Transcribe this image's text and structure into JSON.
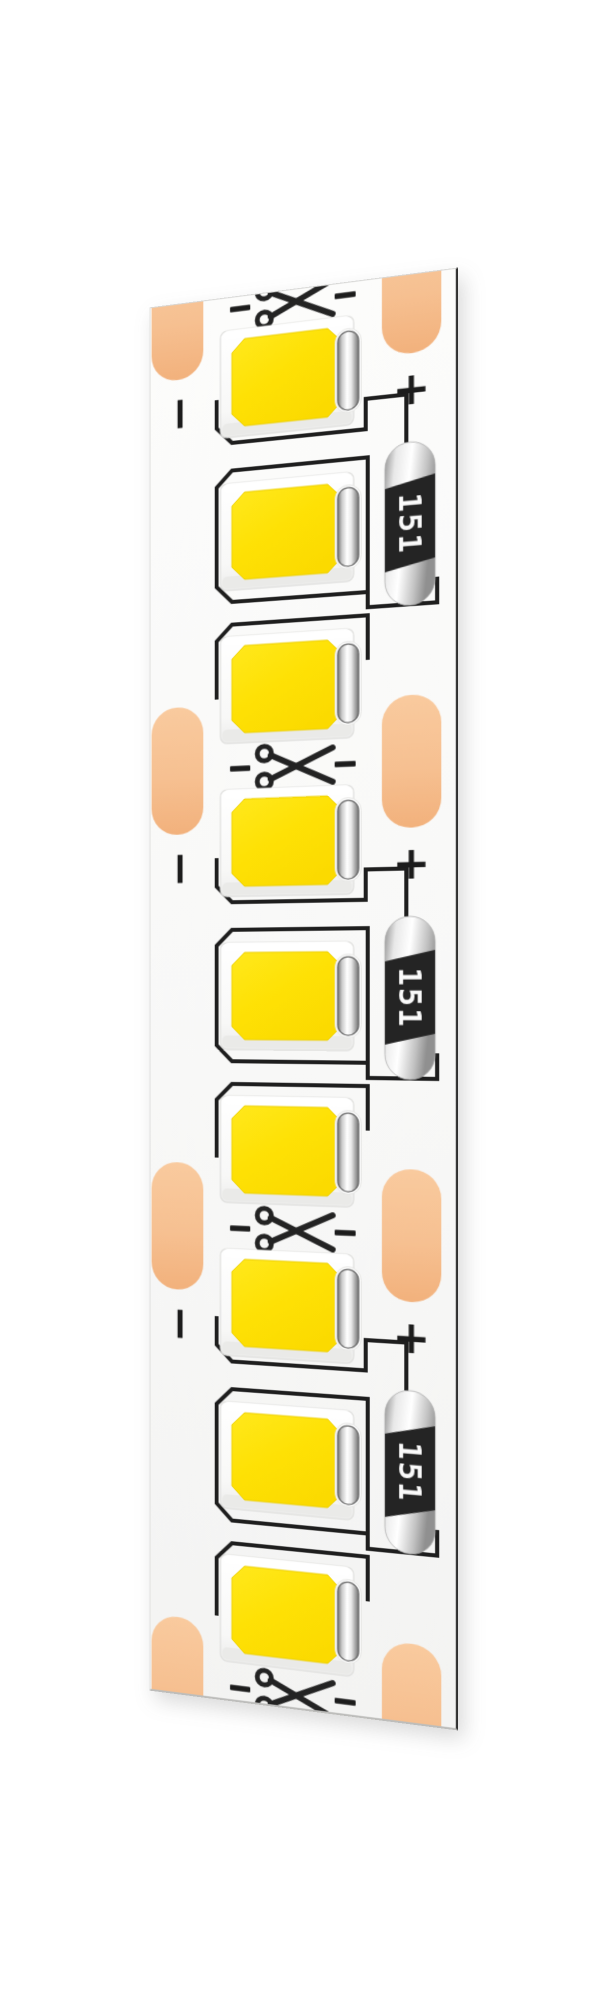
{
  "page": {
    "background_color": "#FFFFFF"
  },
  "strip": {
    "kind_label": "smd-led-strip",
    "surface_color": "#FAFAF9",
    "pad_color_top": "#F9CA9E",
    "pad_color_bottom": "#F2B17C",
    "led_yellow_light": "#FFE81C",
    "led_yellow_deep": "#FBDA00",
    "package_white": "#FFFFFF",
    "trace_color": "#1E1E1E",
    "mark_color": "#1C1C1C",
    "scissors_color": "#232323",
    "resistor_body_color": "#242424",
    "resistor_text_color": "#FAFAFA",
    "led_count": 9,
    "cut_mark_count": 4,
    "resistor_count": 3,
    "cut_marks": [
      {
        "icon": "scissors-icon",
        "clipped": true
      },
      {
        "icon": "scissors-icon",
        "clipped": false
      },
      {
        "icon": "scissors-icon",
        "clipped": false
      },
      {
        "icon": "scissors-icon",
        "clipped": true
      }
    ],
    "segments": [
      {
        "minus_label": "−",
        "plus_label": "+",
        "resistor_label": "151"
      },
      {
        "minus_label": "−",
        "plus_label": "+",
        "resistor_label": "151"
      },
      {
        "minus_label": "−",
        "plus_label": "+",
        "resistor_label": "151"
      }
    ]
  }
}
